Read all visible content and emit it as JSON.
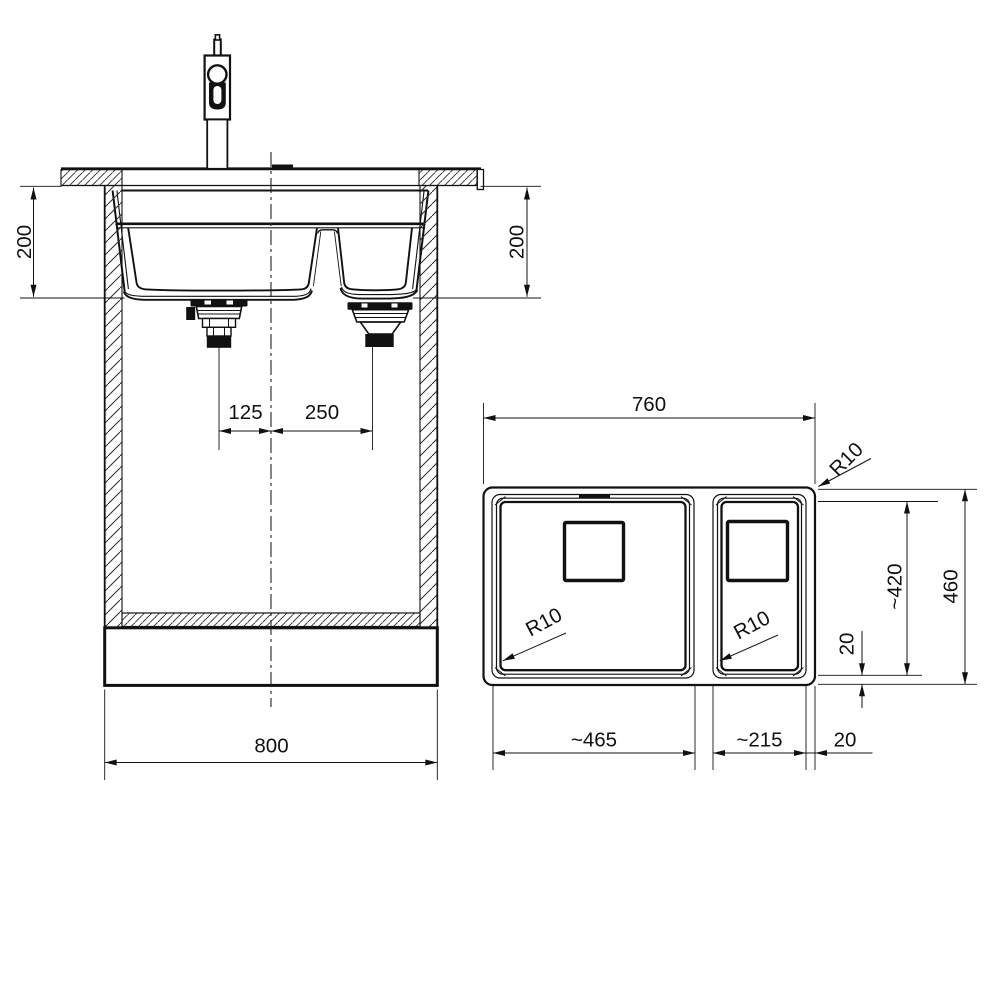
{
  "drawing": {
    "background": "#ffffff",
    "line_color": "#111111"
  },
  "front_view": {
    "dims": {
      "bowl_depth_left": "200",
      "bowl_depth_right": "200",
      "main_drain_to_center": "125",
      "center_to_half_drain": "250",
      "cabinet_width": "800"
    }
  },
  "plan_view": {
    "dims": {
      "overall_length": "760",
      "overall_depth": "460",
      "bowl_zone_depth": "~420",
      "back_rim": "20",
      "side_rim": "20",
      "main_bowl_length": "~465",
      "half_bowl_length": "~215",
      "outer_corner_radius": "R10",
      "main_bowl_radius": "R10",
      "half_bowl_radius": "R10"
    }
  }
}
